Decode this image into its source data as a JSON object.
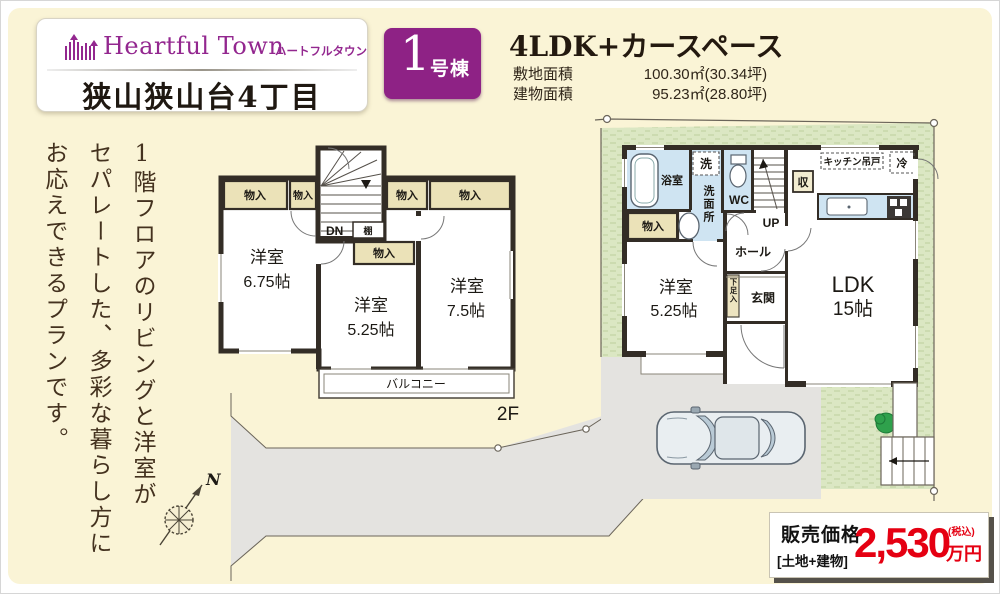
{
  "header": {
    "brand_en": "Heartful Town",
    "brand_kana": "ハートフルタウン",
    "location": "狭山狭山台4丁目",
    "badge_number": "1",
    "badge_suffix": "号棟",
    "plan_title": "4LDK+カースペース",
    "land_label": "敷地面積",
    "land_value": "100.30㎡(30.34坪)",
    "bldg_label": "建物面積",
    "bldg_value": "95.23㎡(28.80坪)"
  },
  "description": {
    "col1": "1階フロアのリビングと洋室が",
    "col2": "セパレートした、多彩な暮らし方に",
    "col3": "お応えできるプランです。"
  },
  "compass": {
    "north": "N"
  },
  "floor2": {
    "floor_label": "2F",
    "down": "DN",
    "shelf": "棚",
    "closet1": "物入",
    "closet2": "物入",
    "closet3": "物入",
    "closet4": "物入",
    "closet5": "物入",
    "room1_name": "洋室",
    "room1_size": "6.75帖",
    "room2_name": "洋室",
    "room2_size": "5.25帖",
    "room3_name": "洋室",
    "room3_size": "7.5帖",
    "balcony": "バルコニー"
  },
  "floor1": {
    "bath": "浴室",
    "laundry": "洗",
    "washroom": "洗面所",
    "wc": "WC",
    "up": "UP",
    "storage": "収",
    "kitchen_cab": "キッチン吊戸",
    "fridge": "冷",
    "closet": "物入",
    "hall": "ホール",
    "entrance": "玄関",
    "shoebox": "下足入",
    "room_name": "洋室",
    "room_size": "5.25帖",
    "ldk_name": "LDK",
    "ldk_size": "15帖"
  },
  "price": {
    "label": "販売価格",
    "sublabel": "[土地+建物]",
    "amount": "2,530",
    "unit": "万円",
    "tax": "(税込)"
  },
  "colors": {
    "accent_purple": "#8e2285",
    "price_red": "#e50012",
    "cream_bg": "#faf4d6",
    "lawn_green": "#dbe7c3",
    "water_blue": "#cfe4f2",
    "closet_beige": "#ebe2b8"
  }
}
